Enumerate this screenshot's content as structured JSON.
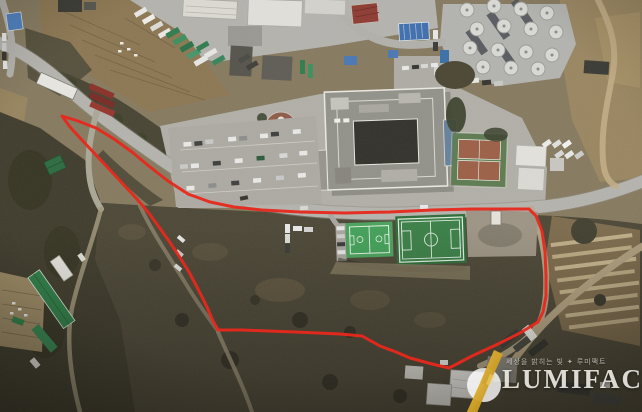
{
  "scene": {
    "type": "satellite-aerial-photo",
    "width": 642,
    "height": 412,
    "description": "Aerial view of hillside campus: building complex, parking lots, tennis courts, futsal and soccer fields, storage-tank facility, greenhouses, terraced fields, with a red site-boundary overlay"
  },
  "palette": {
    "annotation_red": "#e8281c",
    "brand_gold": "#d7a019",
    "brand_gold_dark": "#b07c0e",
    "watermark_white": "#f3f1ea",
    "field_green": "#43a159",
    "pitch_green": "#3a7f46",
    "tennis_clay": "#9c5f46",
    "road_gray": "#b5b3ad"
  },
  "annotation": {
    "boundary": {
      "color": "#e8281c",
      "stroke_width": 3,
      "points": [
        [
          62,
          116
        ],
        [
          78,
          121
        ],
        [
          96,
          128
        ],
        [
          114,
          139
        ],
        [
          132,
          152
        ],
        [
          150,
          167
        ],
        [
          168,
          181
        ],
        [
          188,
          194
        ],
        [
          210,
          202
        ],
        [
          234,
          207
        ],
        [
          262,
          210
        ],
        [
          300,
          212
        ],
        [
          345,
          213
        ],
        [
          390,
          212
        ],
        [
          432,
          210
        ],
        [
          472,
          209
        ],
        [
          505,
          209
        ],
        [
          529,
          209
        ],
        [
          536,
          216
        ],
        [
          542,
          231
        ],
        [
          545,
          252
        ],
        [
          546,
          275
        ],
        [
          546,
          296
        ],
        [
          543,
          312
        ],
        [
          538,
          322
        ],
        [
          520,
          333
        ],
        [
          498,
          344
        ],
        [
          472,
          356
        ],
        [
          449,
          368
        ],
        [
          432,
          364
        ],
        [
          410,
          358
        ],
        [
          396,
          352
        ],
        [
          380,
          346
        ],
        [
          362,
          336
        ],
        [
          340,
          334
        ],
        [
          318,
          333
        ],
        [
          295,
          332
        ],
        [
          268,
          331
        ],
        [
          242,
          330
        ],
        [
          218,
          330
        ],
        [
          213,
          321
        ],
        [
          207,
          307
        ],
        [
          198,
          289
        ],
        [
          189,
          272
        ],
        [
          179,
          256
        ],
        [
          169,
          241
        ],
        [
          159,
          227
        ],
        [
          148,
          212
        ],
        [
          136,
          198
        ],
        [
          123,
          184
        ],
        [
          109,
          169
        ],
        [
          95,
          154
        ],
        [
          81,
          139
        ],
        [
          70,
          127
        ]
      ]
    }
  },
  "watermark": {
    "brand": "LUMIFACT",
    "tagline": "세상을 밝히는 빛 ✦ 루미팩트"
  },
  "features": [
    "main-building-complex",
    "storage-tank-facility",
    "tennis-courts",
    "futsal-court",
    "soccer-field",
    "gravel-yard",
    "parking-lot",
    "circular-plaza",
    "truck-yard",
    "warehouse-buildings",
    "greenhouse-buildings",
    "terraced-fields",
    "dirt-paths",
    "main-road",
    "bottom-buildings",
    "site-boundary"
  ]
}
